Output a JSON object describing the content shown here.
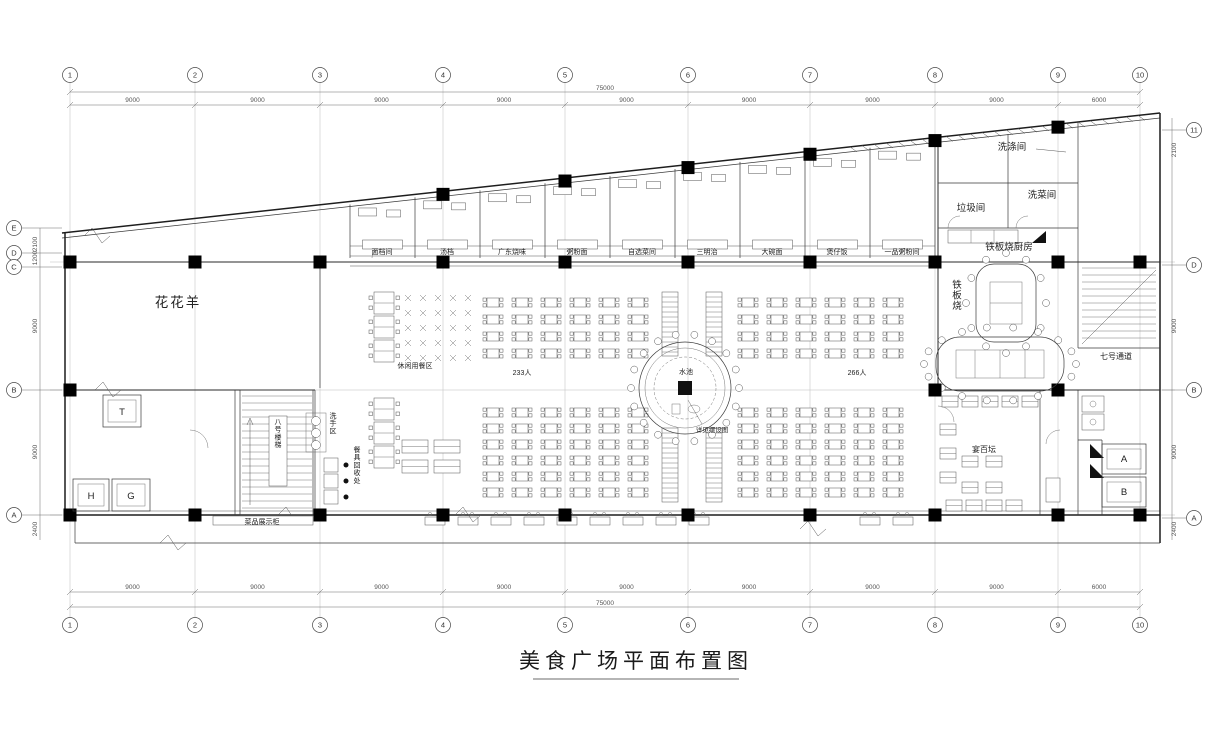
{
  "title": "美食广场平面布置图",
  "grid": {
    "top_labels": [
      "1",
      "2",
      "3",
      "4",
      "5",
      "6",
      "7",
      "8",
      "9",
      "10"
    ],
    "bottom_labels": [
      "1",
      "2",
      "3",
      "4",
      "5",
      "6",
      "7",
      "8",
      "9",
      "10"
    ],
    "left_labels": [
      "E",
      "D",
      "C",
      "B",
      "A"
    ],
    "right_labels": [
      "11",
      "D",
      "B",
      "A"
    ]
  },
  "dimensions": {
    "overall_top": "75000",
    "overall_bottom": "75000",
    "top_segments": [
      "9000",
      "9000",
      "9000",
      "9000",
      "9000",
      "9000",
      "9000",
      "9000",
      "6000"
    ],
    "bottom_segments": [
      "9000",
      "9000",
      "9000",
      "9000",
      "9000",
      "9000",
      "9000",
      "9000",
      "6000"
    ],
    "left_segments": [
      "2100",
      "1200",
      "9000",
      "9000",
      "2400"
    ],
    "right_segments": [
      "2100",
      "9000",
      "9000",
      "2400"
    ]
  },
  "rooms": {
    "brand_area": "花花羊",
    "wash_room": "洗涤间",
    "trash_room": "垃圾间",
    "veg_wash_room": "洗菜间",
    "teppanyaki_kitchen": "铁板烧厨房",
    "teppanyaki_area": "铁板烧",
    "banquet_area": "宴百坛",
    "passage_7": "七号通道",
    "stair_8": "八号楼梯",
    "display_cabinet": "菜品展示柜",
    "hand_wash": "洗手区",
    "tableware_return": "餐具回收处",
    "dining_area": "休闲用餐区",
    "capacity_left": "233人",
    "capacity_right": "266人",
    "pool": "水池",
    "pool_note": "详见摆设图"
  },
  "stalls": [
    "面档间",
    "汤档",
    "广东烧味",
    "粥粉面",
    "自选菜间",
    "三明治",
    "大碗面",
    "煲仔饭",
    "一品粥粉间"
  ],
  "elevators": {
    "left": [
      "T",
      "H",
      "G"
    ],
    "right": [
      "A",
      "B"
    ]
  }
}
